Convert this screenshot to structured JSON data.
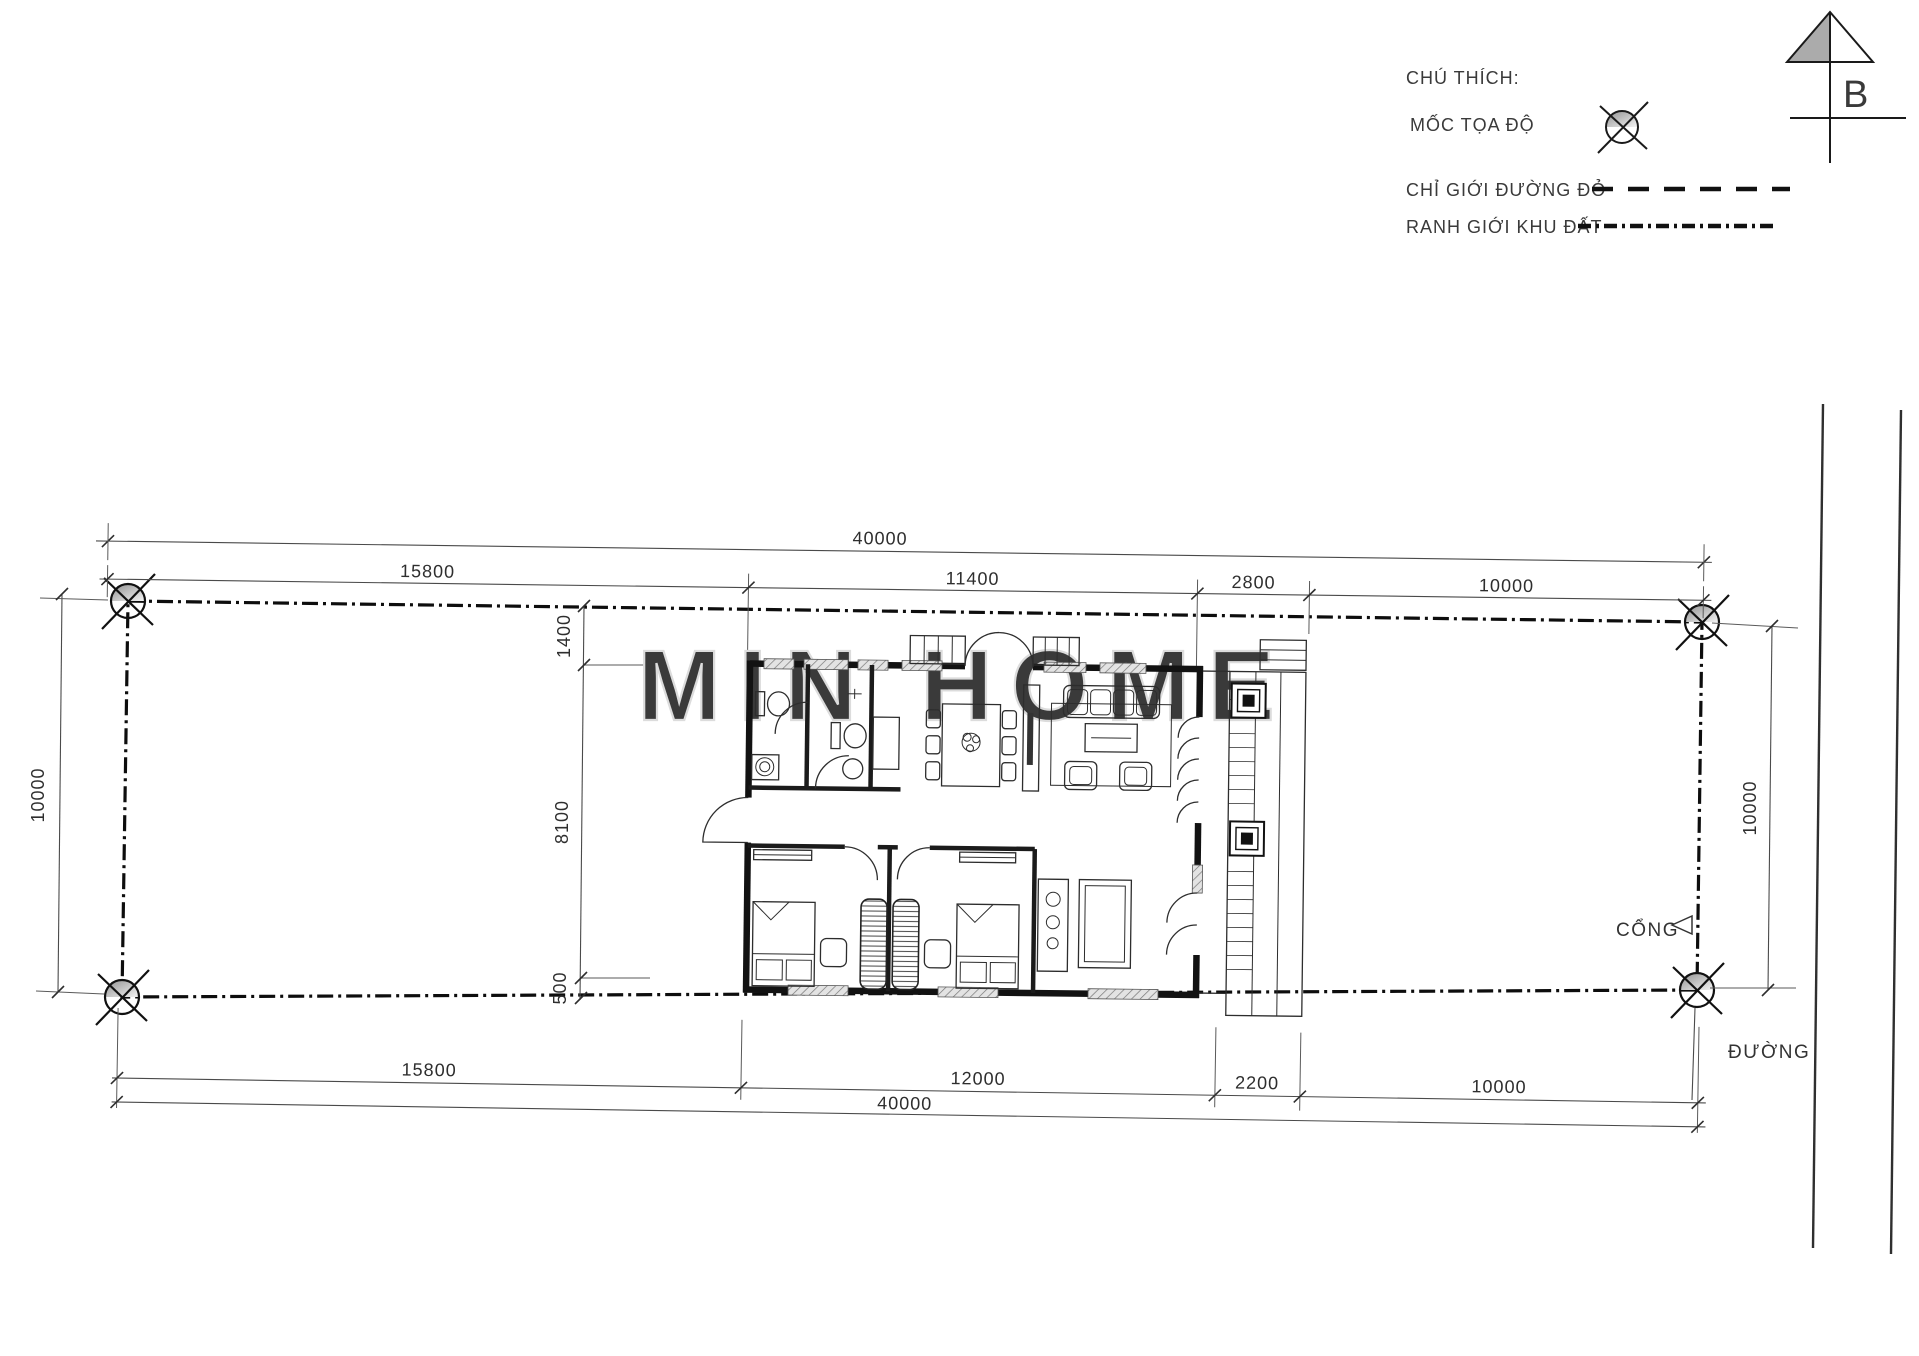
{
  "legend": {
    "title": "CHÚ THÍCH:",
    "items": [
      {
        "label": "MỐC TỌA ĐỘ",
        "symbol": "survey-marker"
      },
      {
        "label": "CHỈ GIỚI ĐƯỜNG ĐỎ",
        "symbol": "dashed-line"
      },
      {
        "label": "RANH GIỚI KHU ĐẤT",
        "symbol": "dash-dot-line"
      }
    ]
  },
  "north_arrow": {
    "label": "B"
  },
  "site_labels": {
    "gate": "CỔNG",
    "road": "ĐƯỜNG"
  },
  "dimensions": {
    "top_total": "40000",
    "top_segments": [
      "15800",
      "11400",
      "2800",
      "10000"
    ],
    "bottom_segments": [
      "15800",
      "12000",
      "2200",
      "10000"
    ],
    "bottom_total": "40000",
    "left_side": "10000",
    "right_side": "10000",
    "column_segments": [
      "1400",
      "8100",
      "500"
    ]
  },
  "watermark": "MIN HOME",
  "colors": {
    "drawing_line": "#121212",
    "dimension_line": "#4a4a4a",
    "watermark": "#dcdcdc"
  }
}
